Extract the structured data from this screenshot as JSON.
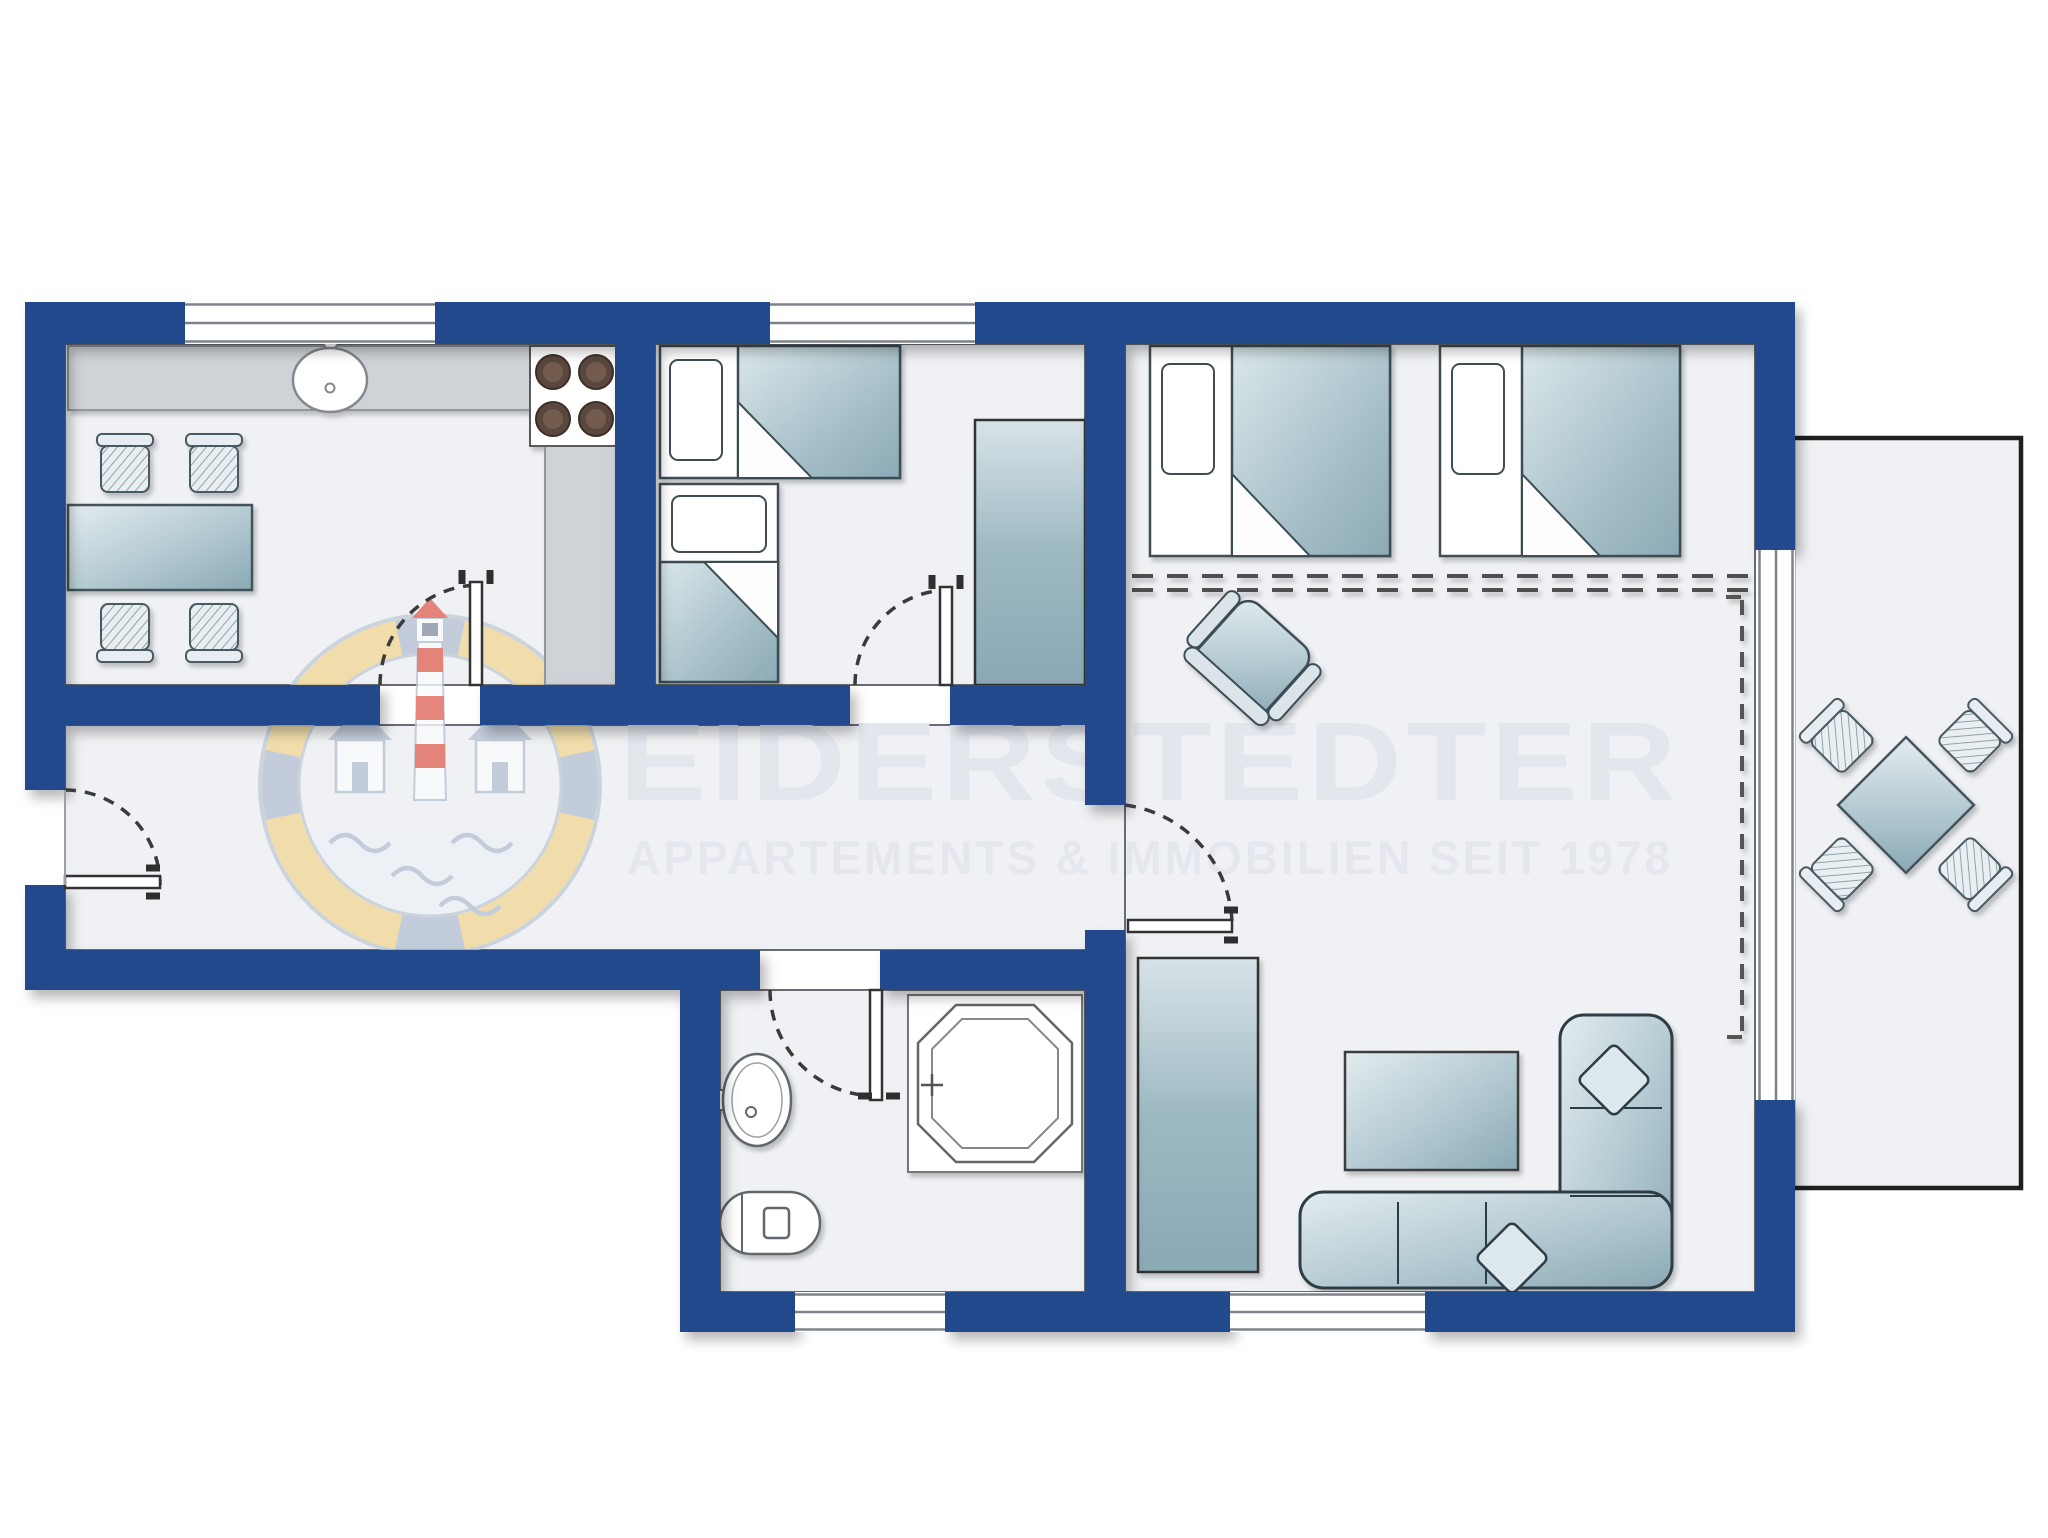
{
  "watermark": {
    "title": "EIDERSTEDTER",
    "subtitle": "APPARTEMENTS & IMMOBILIEN SEIT 1978",
    "text_color": "#e2e6ed"
  },
  "palette": {
    "wall_blue": "#24498b",
    "floor": "#eff1f4",
    "outside_white": "#ffffff",
    "counter_gray": "#cfd3d7",
    "furniture_teal_light": "#dfe9ec",
    "furniture_teal_dark": "#8fadb9",
    "outline_dark": "#3d4d55",
    "terrace_border": "#1f1f1f",
    "window_line": "#7d838a",
    "burner_brown": "#5a463c",
    "logo_yellow": "#f1d999",
    "logo_blue_gray": "#b8c4d4",
    "logo_red": "#e2685c"
  },
  "legend": {
    "icons": [
      "window-icon",
      "sliding-window-icon",
      "door-swing-icon",
      "bed-icon",
      "pillow-icon",
      "duvet-icon",
      "wardrobe-icon",
      "dining-table-icon",
      "chair-icon",
      "kitchen-counter-icon",
      "stove-burners-icon",
      "sink-icon",
      "armchair-icon",
      "corner-sofa-icon",
      "cushion-icon",
      "coffee-table-icon",
      "shower-icon",
      "toilet-icon",
      "washbasin-icon",
      "terrace-table-icon",
      "room-divider-dashed-icon"
    ]
  }
}
